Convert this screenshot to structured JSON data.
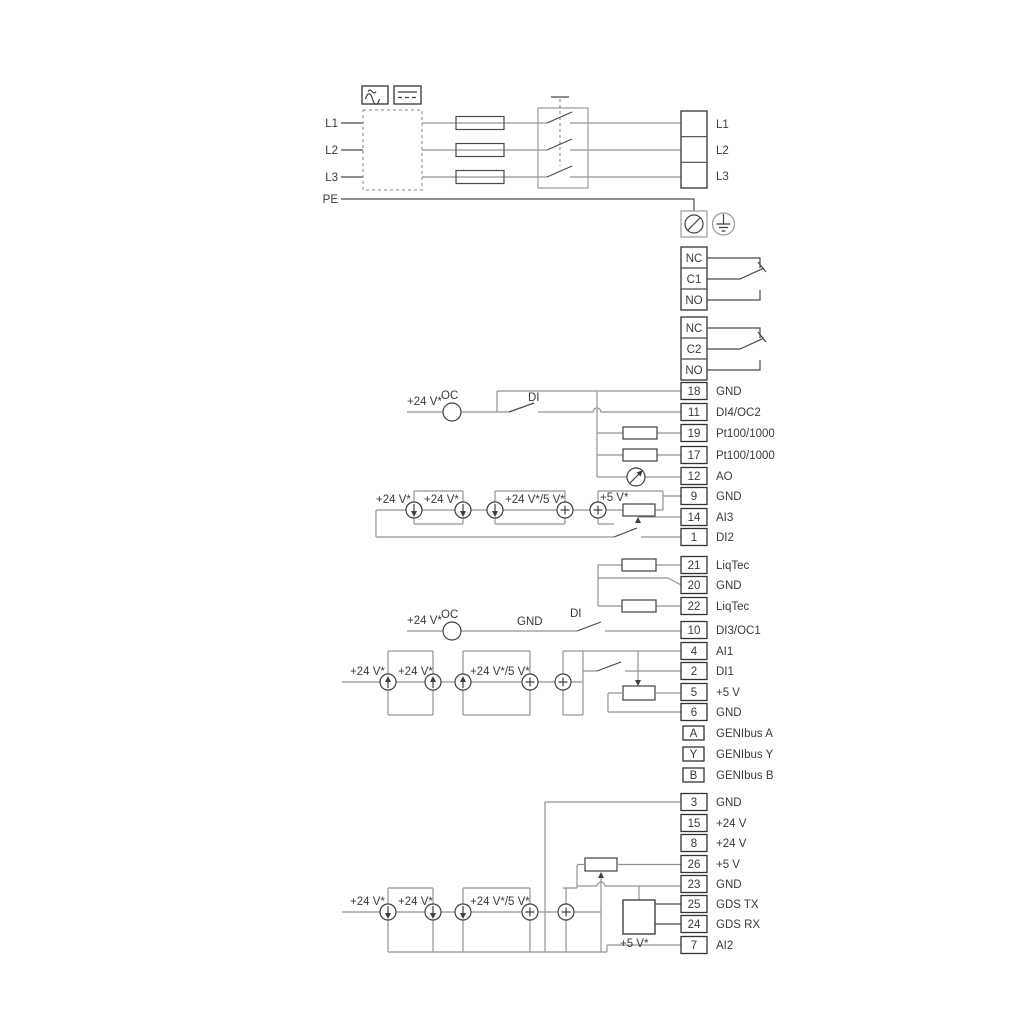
{
  "power_in": {
    "l1": "L1",
    "l2": "L2",
    "l3": "L3",
    "pe": "PE"
  },
  "power_out": {
    "l1": "L1",
    "l2": "L2",
    "l3": "L3"
  },
  "relay1": {
    "nc": "NC",
    "com": "C1",
    "no": "NO"
  },
  "relay2": {
    "nc": "NC",
    "com": "C2",
    "no": "NO"
  },
  "io_top": [
    {
      "num": "18",
      "label": "GND"
    },
    {
      "num": "11",
      "label": "DI4/OC2"
    },
    {
      "num": "19",
      "label": "Pt100/1000"
    },
    {
      "num": "17",
      "label": "Pt100/1000"
    },
    {
      "num": "12",
      "label": "AO"
    },
    {
      "num": "9",
      "label": "GND"
    },
    {
      "num": "14",
      "label": "AI3"
    },
    {
      "num": "1",
      "label": "DI2"
    }
  ],
  "io_liqtec": [
    {
      "num": "21",
      "label": "LiqTec"
    },
    {
      "num": "20",
      "label": "GND"
    },
    {
      "num": "22",
      "label": "LiqTec"
    }
  ],
  "io_mid": [
    {
      "num": "10",
      "label": "DI3/OC1"
    },
    {
      "num": "4",
      "label": "AI1"
    },
    {
      "num": "2",
      "label": "DI1"
    },
    {
      "num": "5",
      "label": "+5 V"
    },
    {
      "num": "6",
      "label": "GND"
    }
  ],
  "genibus": [
    {
      "num": "A",
      "label": "GENIbus A"
    },
    {
      "num": "Y",
      "label": "GENIbus Y"
    },
    {
      "num": "B",
      "label": "GENIbus B"
    }
  ],
  "io_bottom": [
    {
      "num": "3",
      "label": "GND"
    },
    {
      "num": "15",
      "label": "+24 V"
    },
    {
      "num": "8",
      "label": "+24 V"
    },
    {
      "num": "26",
      "label": "+5 V"
    },
    {
      "num": "23",
      "label": "GND"
    },
    {
      "num": "25",
      "label": "GDS TX"
    },
    {
      "num": "24",
      "label": "GDS RX"
    },
    {
      "num": "7",
      "label": "AI2"
    }
  ],
  "annotations": {
    "v24": "+24 V*",
    "v24_5": "+24 V*/5 V*",
    "v5": "+5 V*",
    "oc": "OC",
    "di": "DI",
    "gnd": "GND"
  },
  "symbols": {
    "ac": "ac-wave-icon",
    "dc": "dc-lines-icon",
    "rectifier_box": "drive-filter-box",
    "fuse": "fuse",
    "disconnect_switch": "3-pole-switch",
    "screw_terminal": "screw-terminal-icon",
    "protective_earth": "earth-ground-icon",
    "current_source": "current-source-icon",
    "voltage_source": "plus-source-icon",
    "open_collector": "open-collector-icon",
    "analog_meter": "meter-icon",
    "potentiometer": "potentiometer",
    "resistor": "resistor",
    "gds_module": "gds-module-box"
  },
  "colors": {
    "line_dark": "#4a4a4a",
    "line_gray": "#949494",
    "text": "#3a3a3a"
  }
}
